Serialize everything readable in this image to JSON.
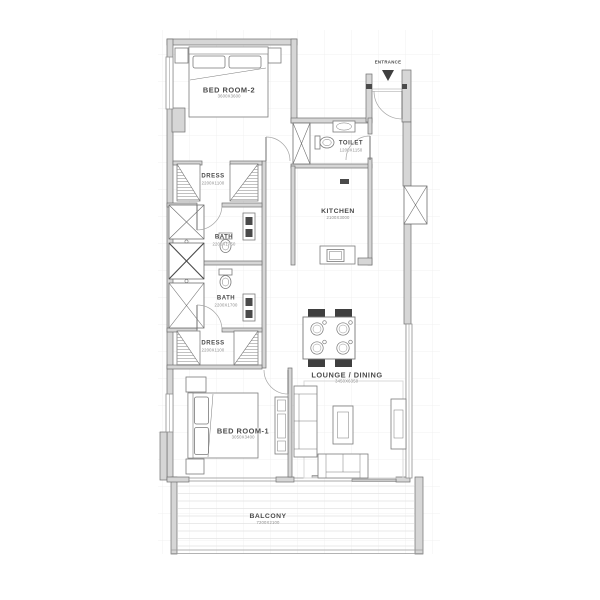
{
  "plan": {
    "entrance_label": "ENTRANCE",
    "rooms": [
      {
        "id": "bedroom-2",
        "name": "BED ROOM-2",
        "dim": "3600X3600"
      },
      {
        "id": "toilet",
        "name": "TOILET",
        "dim": "1200X1150"
      },
      {
        "id": "kitchen",
        "name": "KITCHEN",
        "dim": "2100X3000"
      },
      {
        "id": "dress-upper",
        "name": "DRESS",
        "dim": "2200X1100"
      },
      {
        "id": "bath-upper",
        "name": "BATH",
        "dim": "2200X1750"
      },
      {
        "id": "bath-lower",
        "name": "BATH",
        "dim": "2200X1700"
      },
      {
        "id": "dress-lower",
        "name": "DRESS",
        "dim": "2200X1100"
      },
      {
        "id": "lounge-dining",
        "name": "LOUNGE / DINING",
        "dim": "3450X6350"
      },
      {
        "id": "bedroom-1",
        "name": "BED ROOM-1",
        "dim": "3050X3400"
      },
      {
        "id": "balcony",
        "name": "BALCONY",
        "dim": "7200X2100"
      }
    ],
    "colors": {
      "background": "#ffffff",
      "wall_fill": "#d6d6d6",
      "wall_stroke": "#6f6f6f",
      "grid": "#ececec",
      "furniture_stroke": "#7a7a7a",
      "dark_accent": "#3f3f3f",
      "label_text": "#4a4a4a",
      "dim_text": "#8a8a8a"
    }
  }
}
